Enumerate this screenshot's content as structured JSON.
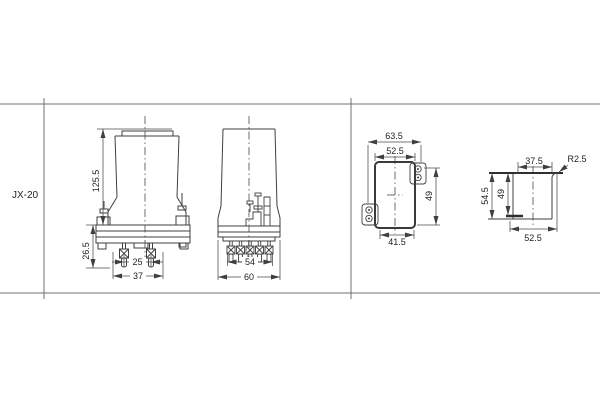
{
  "title_block": {
    "model": "JX-20"
  },
  "views": {
    "front": {
      "height": "125.5",
      "terminal_length": "26.5",
      "pin_spacing": "25",
      "width": "37"
    },
    "side": {
      "pin_row_width": "54",
      "depth": "60"
    },
    "panel_cutout": {
      "hole_span": "63.5",
      "width": "52.5",
      "height": "49",
      "bottom_width": "41.5"
    },
    "side_mount": {
      "top_width": "37.5",
      "corner_radius": "R2.5",
      "height": "54.5",
      "inner_height": "49",
      "bottom_width": "52.5"
    }
  }
}
